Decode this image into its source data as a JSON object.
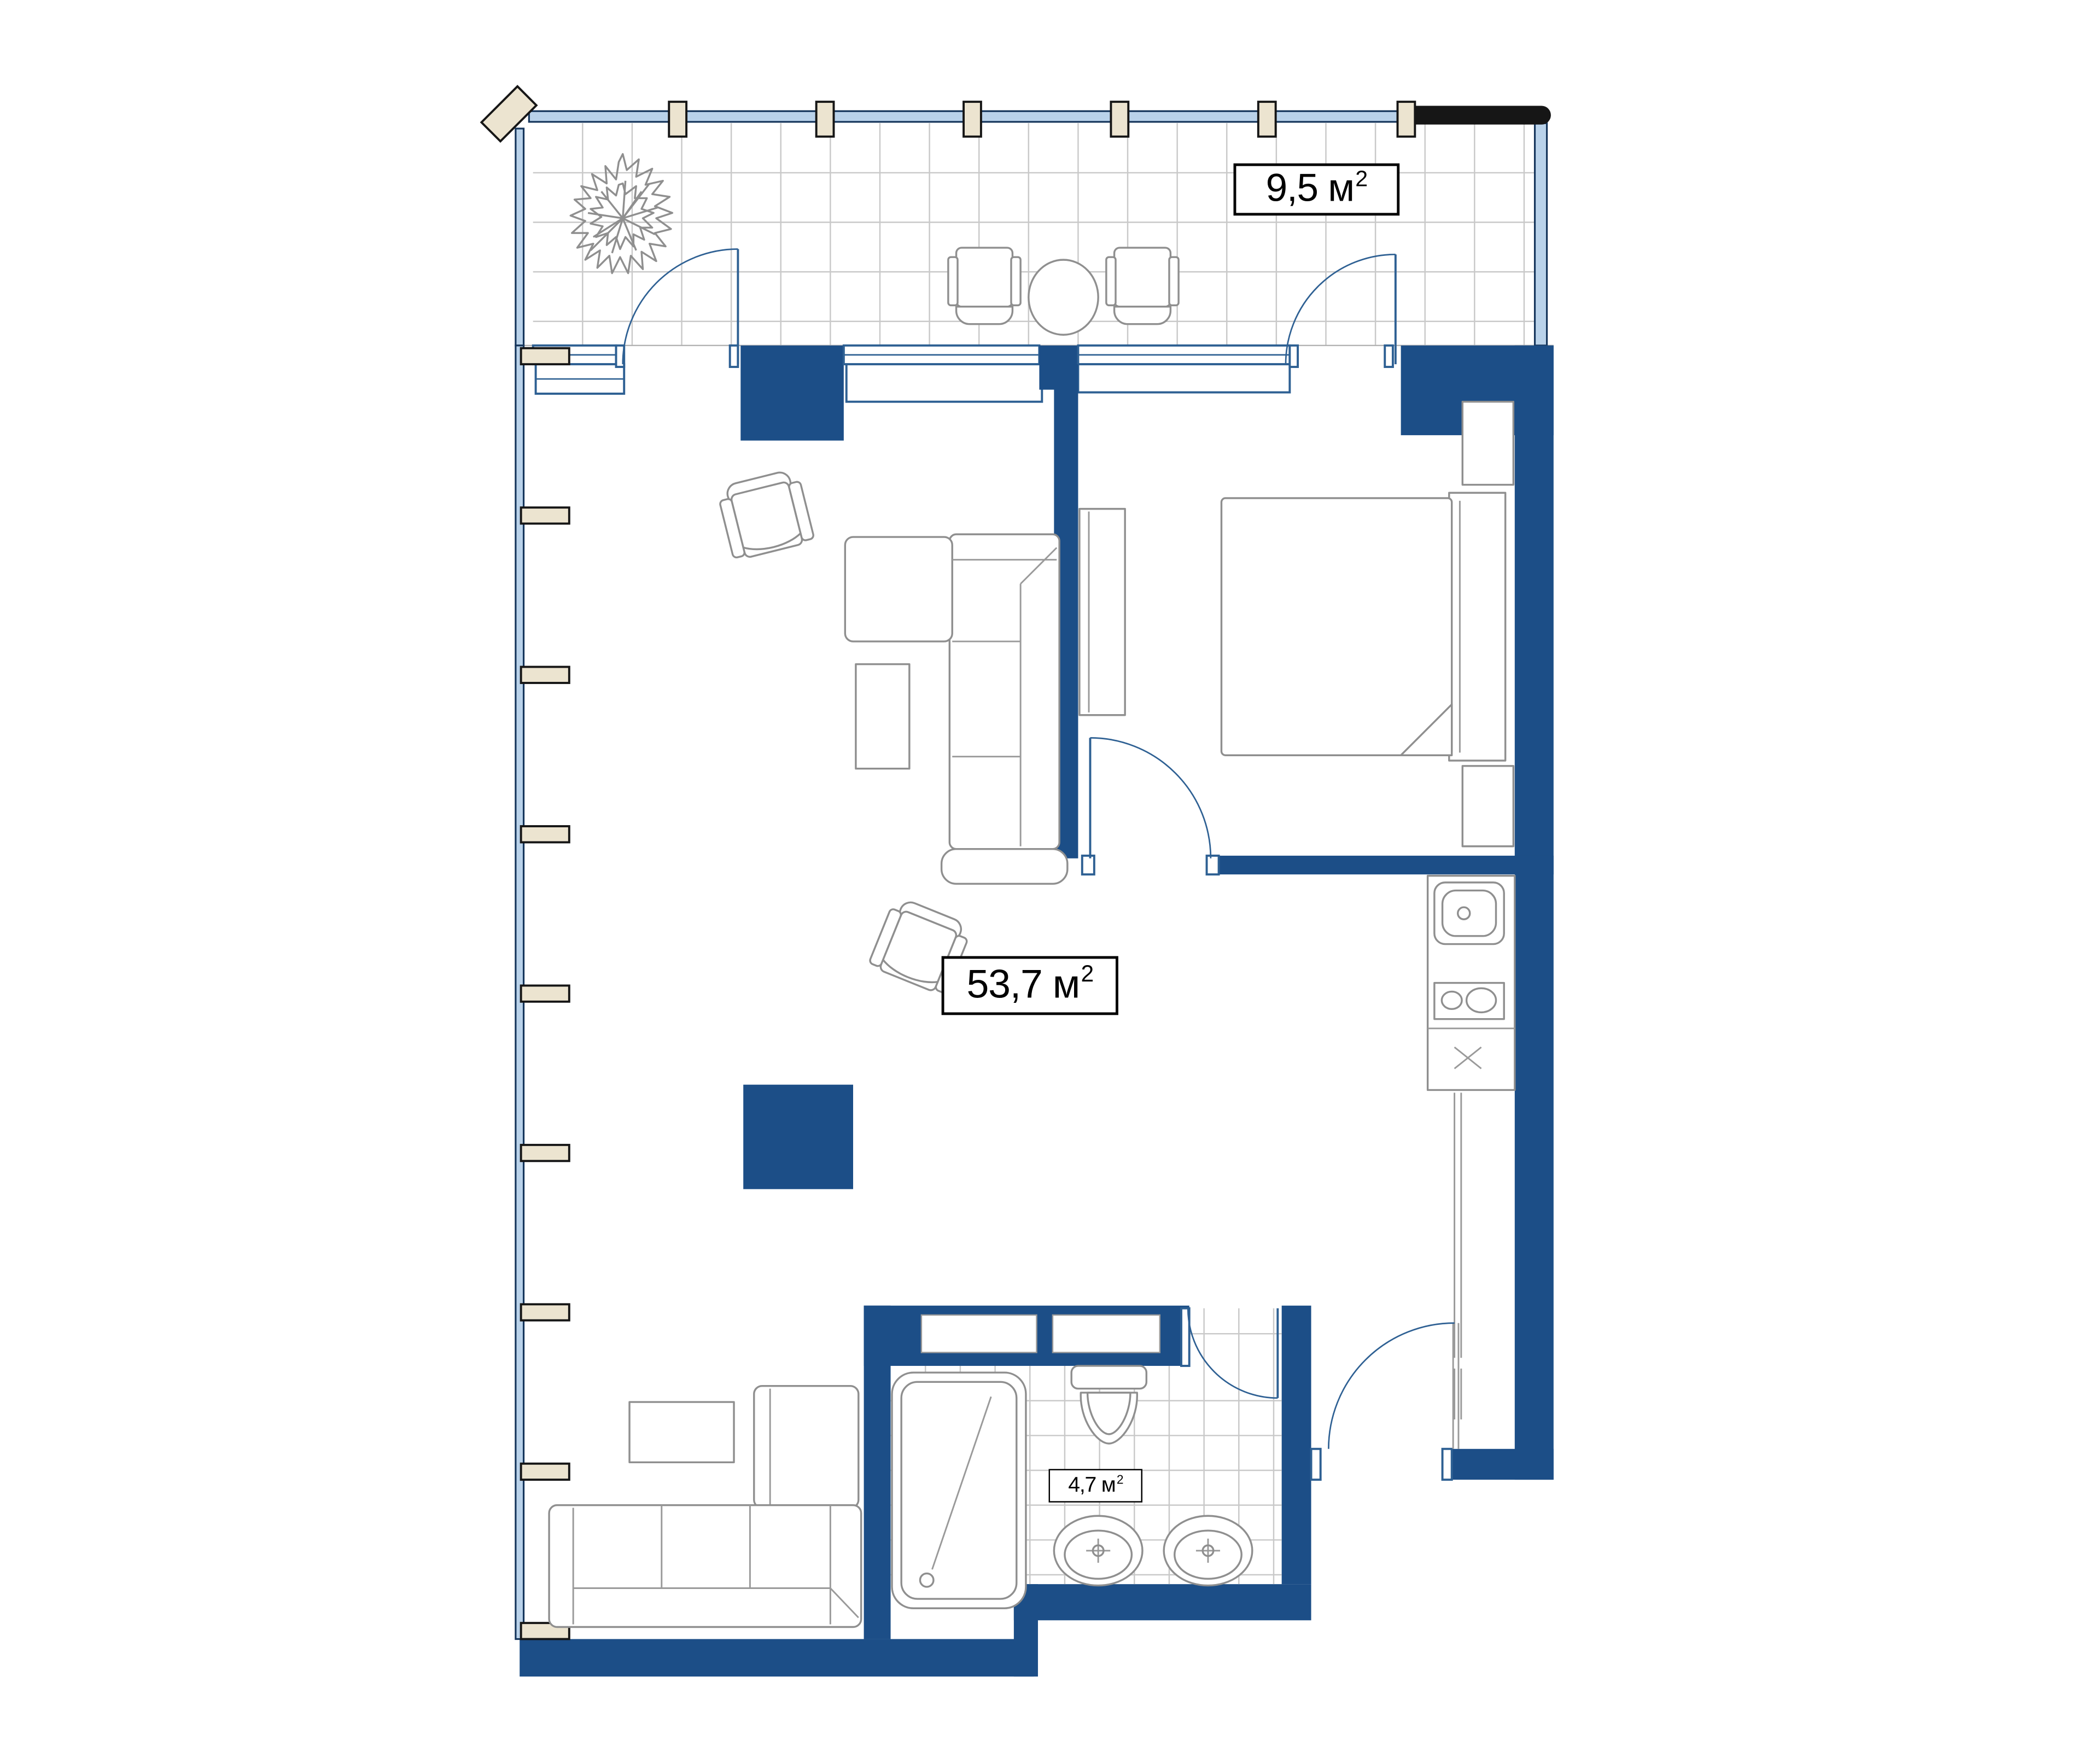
{
  "plan": {
    "type": "apartment-floor-plan",
    "rooms": [
      {
        "id": "balcony",
        "area_value": "9,5 м",
        "area_exp": "2"
      },
      {
        "id": "living-kitchen-room",
        "area_value": "53,7 м",
        "area_exp": "2"
      },
      {
        "id": "bathroom",
        "area_value": "4,7 м",
        "area_exp": "2"
      }
    ],
    "colors": {
      "wall": "#1c4e87",
      "line": "#2e6093",
      "rail": "#161616",
      "furniture": "#8f8f8f",
      "tile": "#c9c9c9",
      "pillar": "#ece4d0",
      "glass": "#b9d2ea",
      "labelBorder": "#000000",
      "bg": "#ffffff"
    }
  }
}
